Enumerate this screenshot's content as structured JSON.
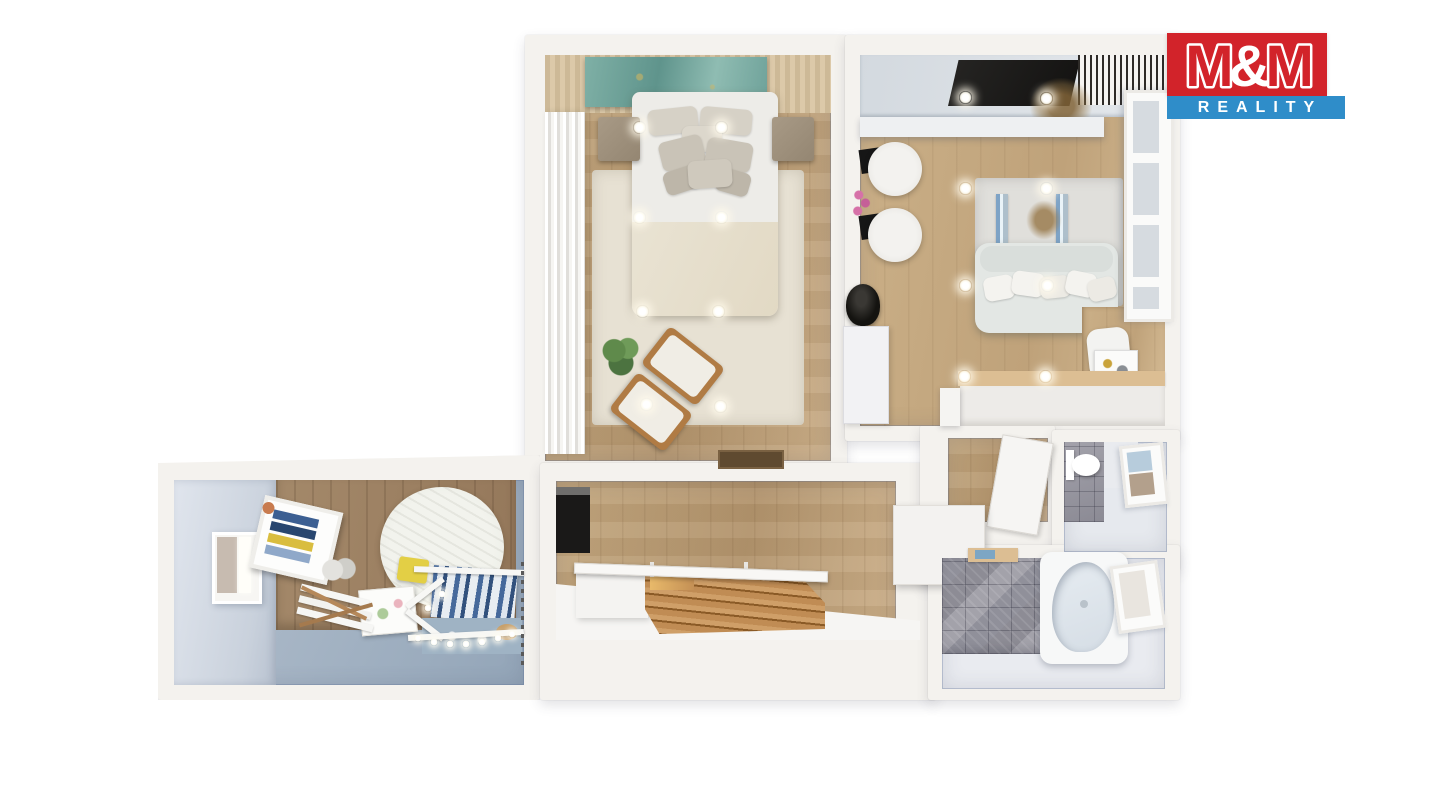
{
  "logo": {
    "m1": "M",
    "amp": "&",
    "m2": "M",
    "reality": "REALITY"
  },
  "palette": {
    "logo_red": "#d2232a",
    "logo_blue": "#2f8dc9",
    "wall": "#f4f2ee",
    "wood_floor": "#c3a77f",
    "wood_floor_light": "#cbb088",
    "wood_wall": "#a4896a",
    "bedroom_rug": "#e7e1d3",
    "living_rug": "#e0dfdb",
    "kids_floor": "#a0b0c1",
    "kids_wall": "#e0e5ed",
    "tile": "#90909a",
    "teal_art": "#6fa29a",
    "furniture_white": "#edece8",
    "sofa": "#e3e7e4",
    "stair_wood": "#b9854d",
    "dark": "#1b1a18",
    "ceiling": "#d3d9df",
    "counter_wood": "#dcbe93",
    "window_pane": "#d6dbe0",
    "bath_floor": "#e9ebf0"
  }
}
